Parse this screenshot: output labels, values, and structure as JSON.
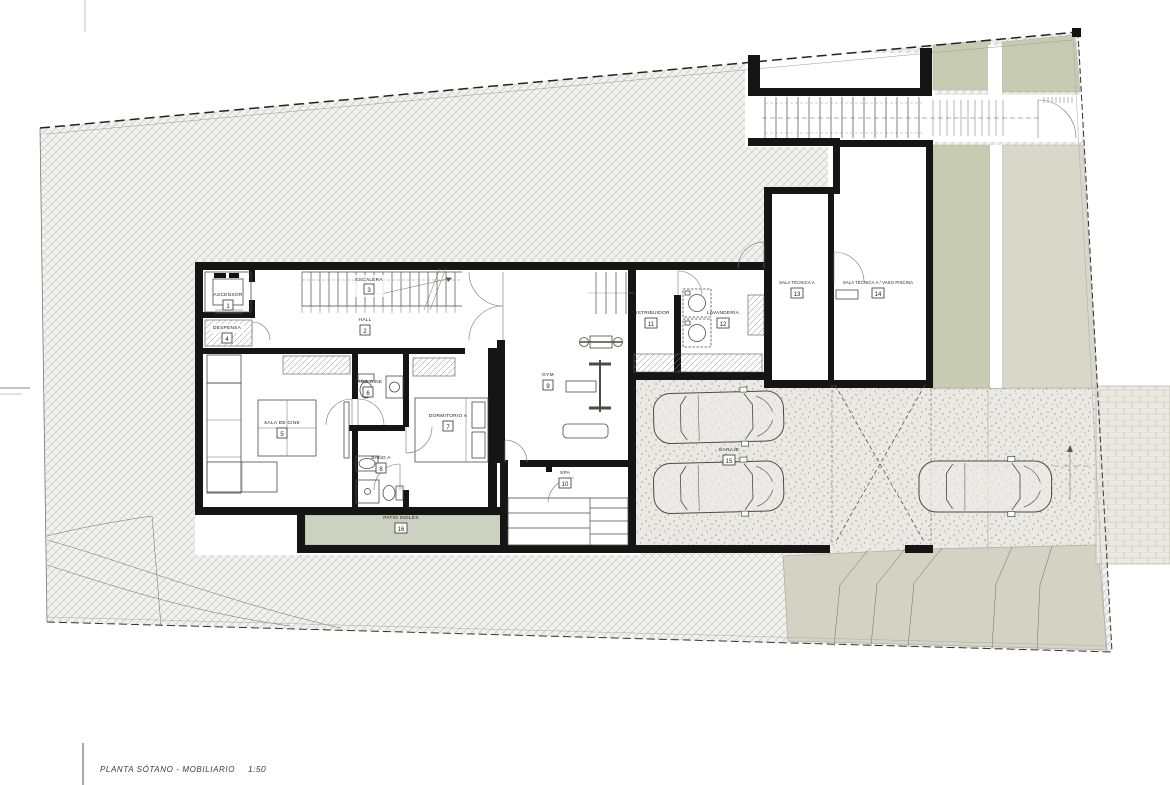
{
  "title_block": {
    "drawing_title": "PLANTA SÓTANO - MOBILIARIO",
    "scale": "1:50"
  },
  "rooms": [
    {
      "name": "ASCENSOR",
      "tag": "1"
    },
    {
      "name": "HALL",
      "tag": "2"
    },
    {
      "name": "ESCALERA",
      "tag": "3"
    },
    {
      "name": "DESPENSA",
      "tag": "4"
    },
    {
      "name": "SALA DE CINE",
      "tag": "5"
    },
    {
      "name": "BAÑO CINE",
      "tag": "6"
    },
    {
      "name": "DORMITORIO A",
      "tag": "7"
    },
    {
      "name": "BAÑO A",
      "tag": "8"
    },
    {
      "name": "GYM",
      "tag": "9"
    },
    {
      "name": "SPA",
      "tag": "10"
    },
    {
      "name": "DISTRIBUIDOR",
      "tag": "11"
    },
    {
      "name": "LAVANDERÍA",
      "tag": "12"
    },
    {
      "name": "SALA TÉCNICA A",
      "tag": "13"
    },
    {
      "name": "SALA TÉCNICA A / VASO PISCINA",
      "tag": "14"
    },
    {
      "name": "GARAJE",
      "tag": "15"
    },
    {
      "name": "PATIO INGLÉS",
      "tag": "16"
    }
  ],
  "colors": {
    "wall": "#151515",
    "terrain_green": "#c7cbb2",
    "patio_green": "#cdd1c0",
    "tan_band": "#d8d7c9",
    "ramp_tan": "#d4d2c3",
    "paving": "#eae9e4",
    "brick": "#ebe9e2"
  }
}
